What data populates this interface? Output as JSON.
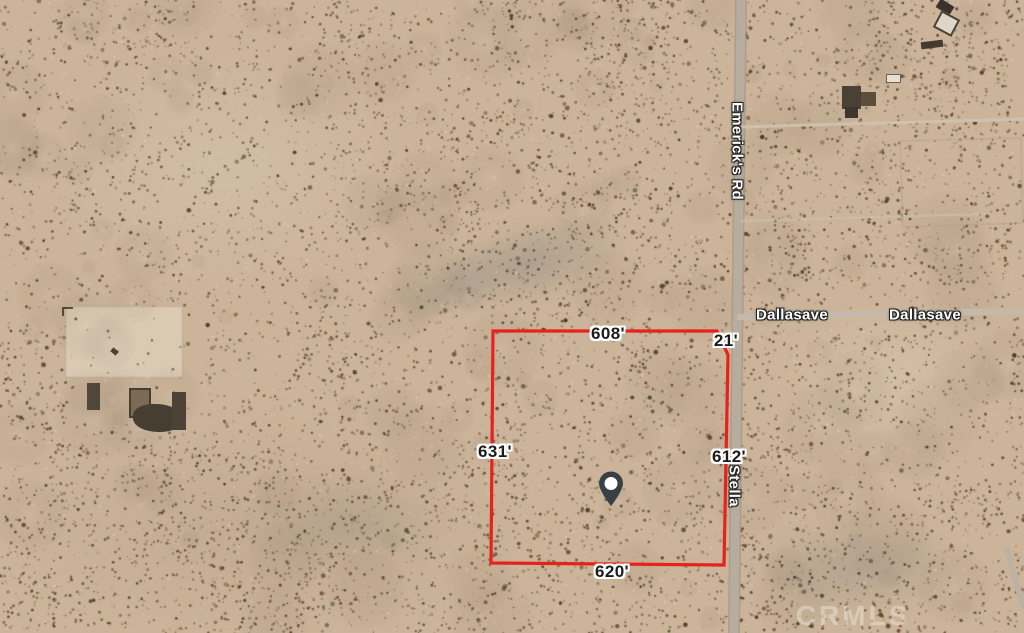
{
  "palette": {
    "sand": "#cbb499",
    "road": "#b6ad9f",
    "speckle": "#5a4129",
    "parcel_red": "#e8211c",
    "pin_dark": "#383f45",
    "label_text": "#1b1b1b"
  },
  "map": {
    "watermark": "CRMLS",
    "road_labels": {
      "emericks": "Emerick's Rd",
      "stella": "Stella",
      "dallasave_east": "Dallasave",
      "dallasave_far_east": "Dallasave"
    },
    "parcel": {
      "outline_color": "#e8211c",
      "measurements": {
        "top": "608'",
        "top_right_corner": "21'",
        "west": "631'",
        "east": "612'",
        "south": "620'"
      }
    },
    "pin": {
      "icon": "location-pin-icon",
      "color": "#383f45"
    }
  }
}
